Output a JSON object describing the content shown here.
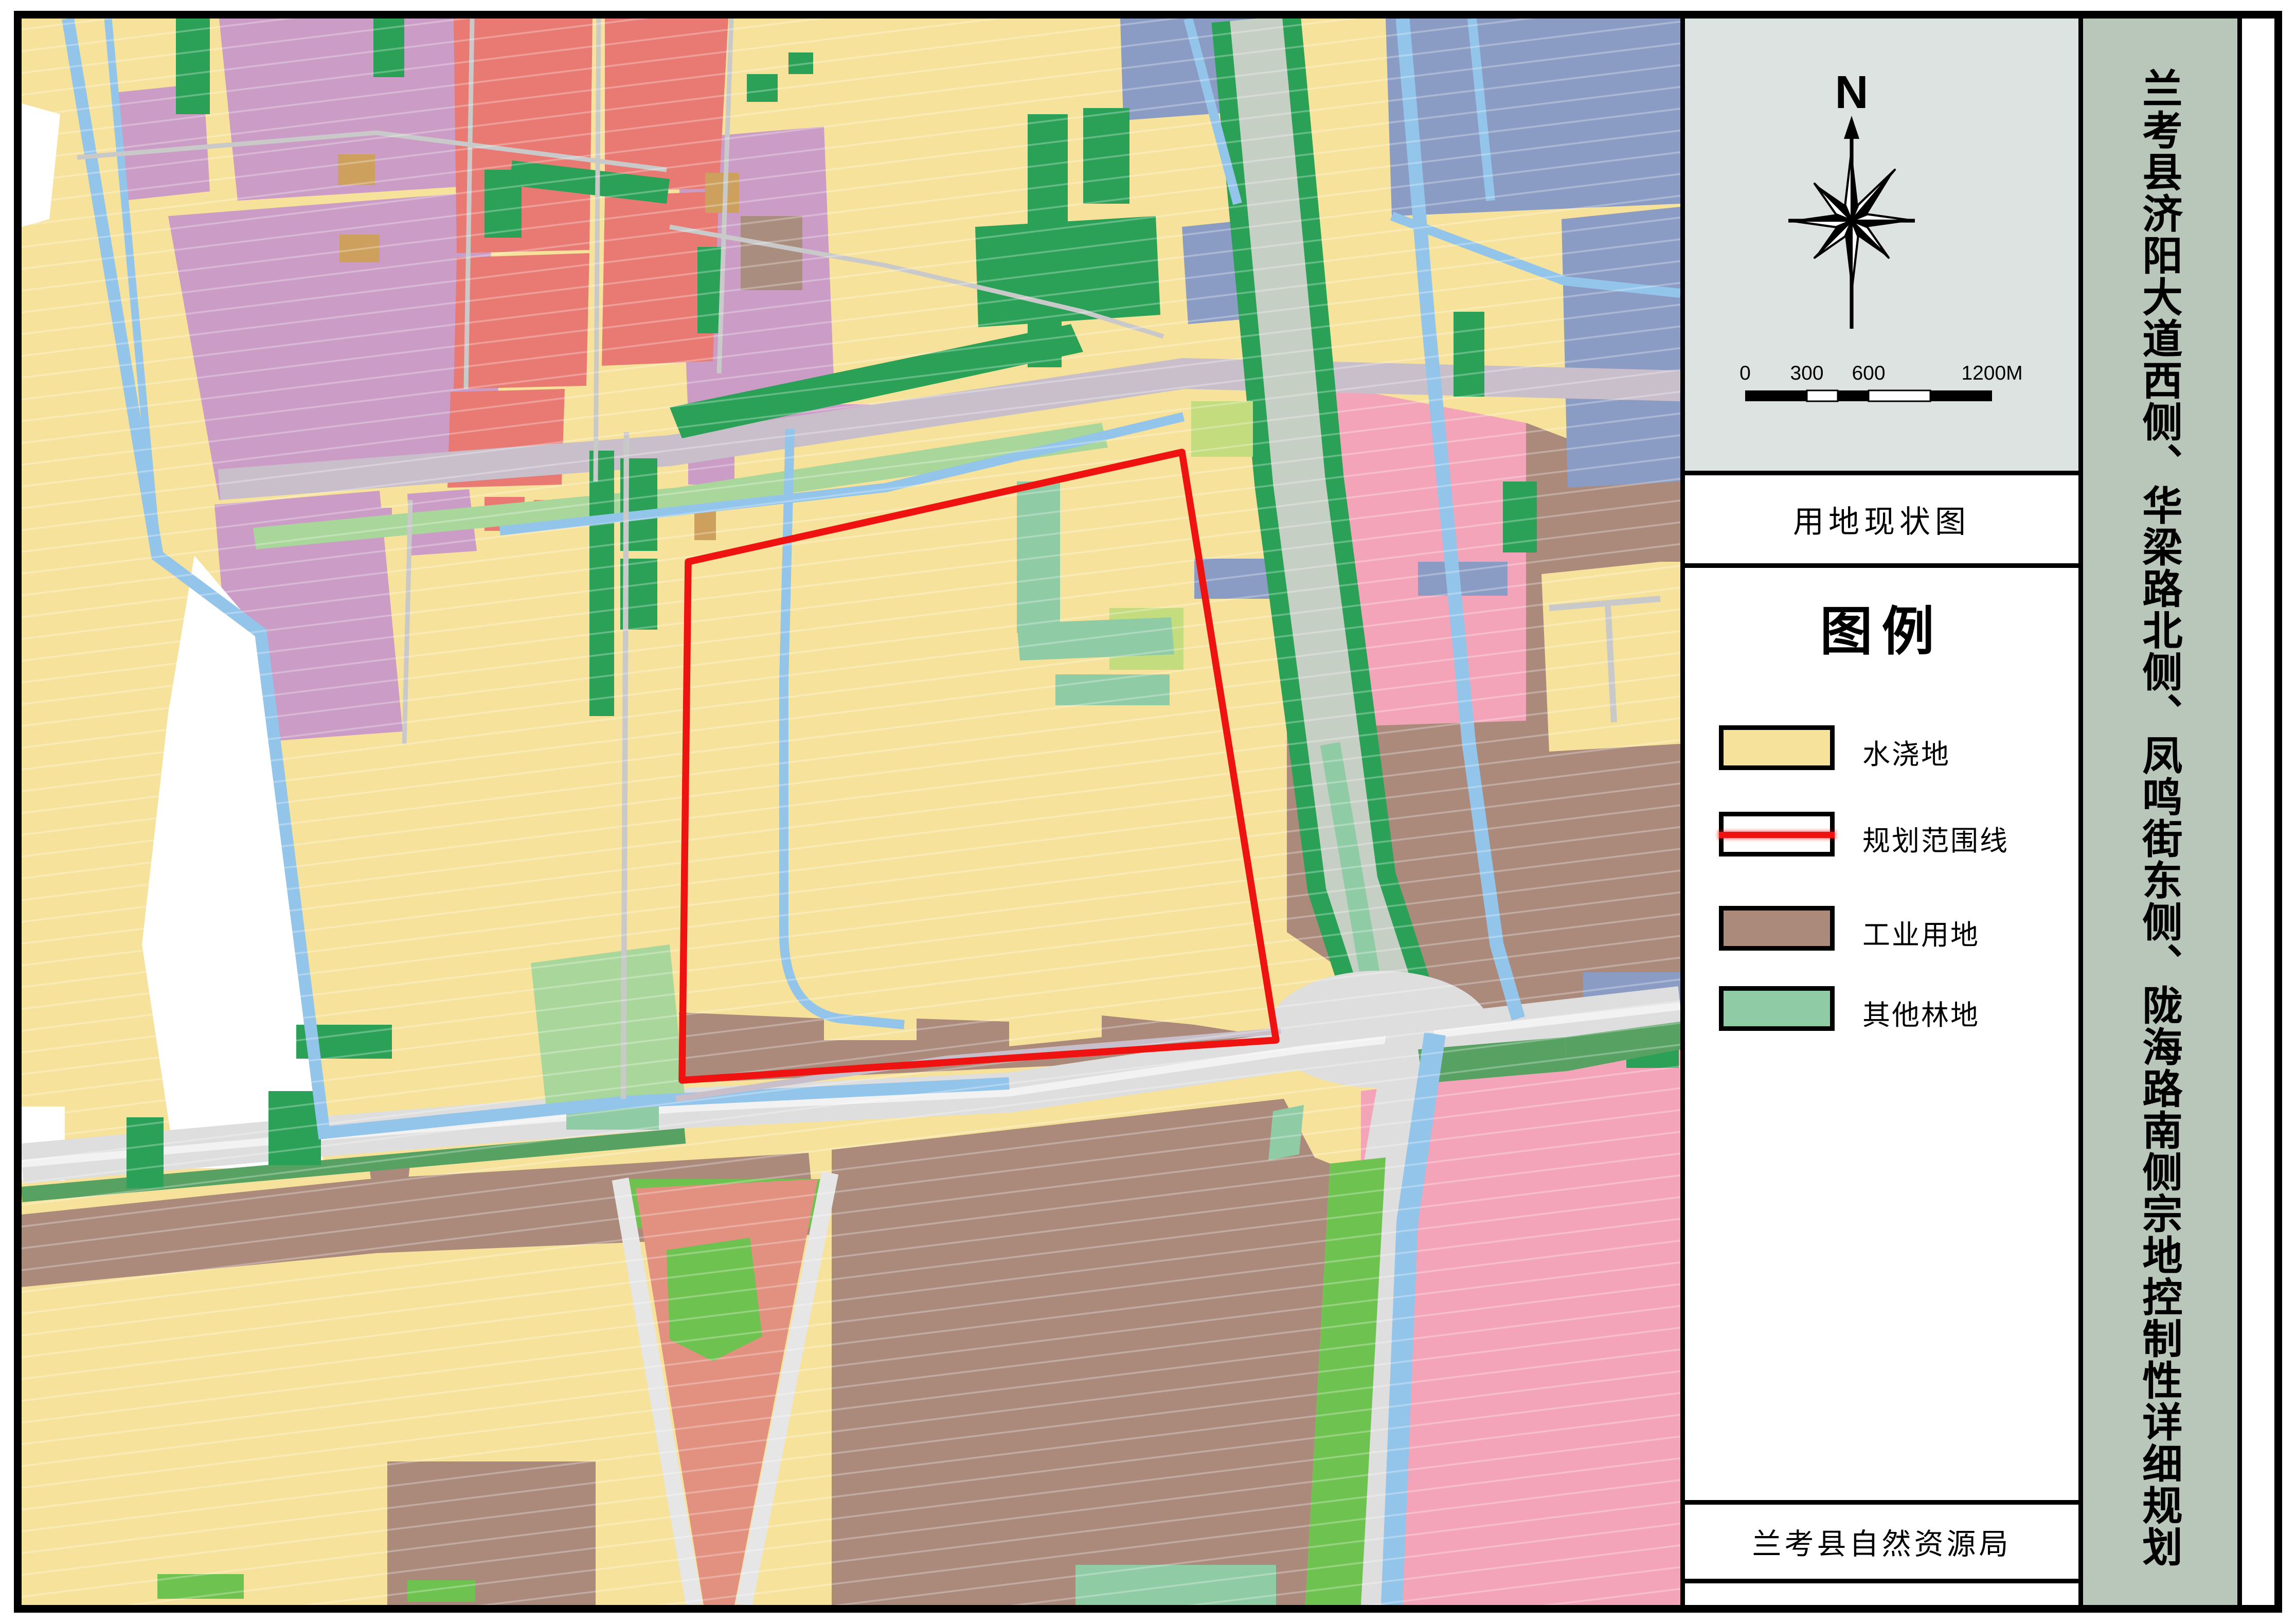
{
  "sidebar": {
    "north_label": "N",
    "scalebar": {
      "labels": [
        "0",
        "300",
        "600",
        "1200M"
      ],
      "total_meters": 1200
    },
    "map_type_label": "用地现状图",
    "legend": {
      "title": "图例",
      "items": [
        {
          "label": "水浇地",
          "swatch_color": "yellow",
          "kind": "fill"
        },
        {
          "label": "规划范围线",
          "swatch_color": "boundary_red",
          "kind": "line"
        },
        {
          "label": "工业用地",
          "swatch_color": "brown",
          "kind": "fill"
        },
        {
          "label": "其他林地",
          "swatch_color": "teal",
          "kind": "fill"
        }
      ]
    },
    "agency_label": "兰考县自然资源局"
  },
  "title_strip": {
    "title": "兰考县济阳大道西侧、华梁路北侧、凤鸣街东侧、陇海路南侧宗地控制性详细规划"
  },
  "palette": {
    "yellow": "#f6e29a",
    "purple": "#cb9cc6",
    "red_parcel": "#e87a73",
    "pink": "#f3a4b8",
    "brown": "#ab8a7c",
    "tan": "#cda15d",
    "taupe": "#a98d7e",
    "slate_blue": "#8b9cc4",
    "dark_green": "#2aa157",
    "medium_green": "#57a163",
    "bright_green": "#6ec24f",
    "light_green": "#a9d79b",
    "lime": "#c3dc7e",
    "teal": "#8fcba5",
    "water": "#93c4ea",
    "road_gray": "#dedede",
    "road_light": "#e6e6e6",
    "road_thin": "#c9c9c9",
    "road_lavender": "#c8bfca",
    "corridor_gray": "#c6cfc3",
    "salmon": "#e2907f",
    "boundary_red": "#ee1310",
    "panel_gray": "#dce3e1",
    "strip_green": "#b9c7ba",
    "white": "#ffffff",
    "black": "#000000"
  }
}
